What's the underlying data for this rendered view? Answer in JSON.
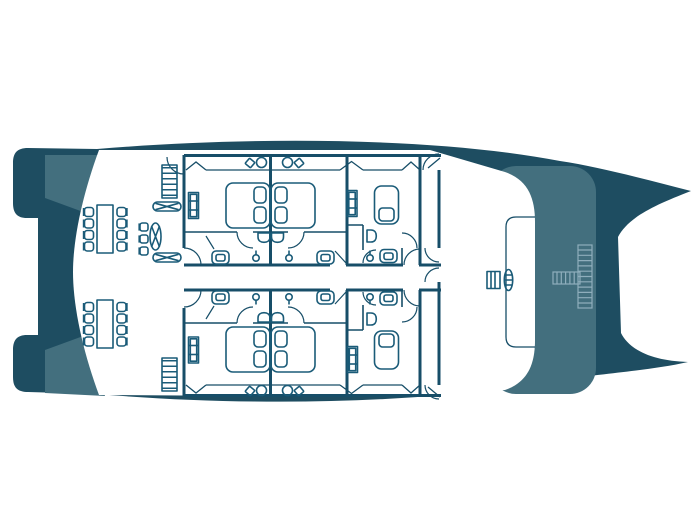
{
  "title": "Catamaran lower deck floor plan",
  "colors": {
    "hull_dark": "#1E4D61",
    "hull_medium": "#436F7E",
    "deck_white": "#FFFFFF",
    "wall_line": "#174E68",
    "furniture_line": "#1A5B78",
    "light_stair_line": "#8FAEBC"
  },
  "plan": {
    "cabins_double": 4,
    "cabins_single": 2,
    "bathrooms": 6,
    "dining_tables": 2,
    "dining_chairs": 16
  },
  "items": [
    {
      "name": "double-bed-cabin-1",
      "sym": "bed-double",
      "x": 248,
      "y": 205.5,
      "sx": 1,
      "sy": 1,
      "r": 0
    },
    {
      "name": "double-bed-cabin-2",
      "sym": "bed-double",
      "x": 293,
      "y": 205.5,
      "sx": -1,
      "sy": 1,
      "r": 0
    },
    {
      "name": "double-bed-cabin-4",
      "sym": "bed-double",
      "x": 248,
      "y": 349.5,
      "sx": 1,
      "sy": 1,
      "r": 0
    },
    {
      "name": "double-bed-cabin-5",
      "sym": "bed-double",
      "x": 293,
      "y": 349.5,
      "sx": -1,
      "sy": 1,
      "r": 0
    },
    {
      "name": "single-bed-cabin-3",
      "sym": "bed-single",
      "x": 386.5,
      "y": 205,
      "sx": 1,
      "sy": 1,
      "r": 0
    },
    {
      "name": "single-bed-cabin-6",
      "sym": "bed-single",
      "x": 386.5,
      "y": 350,
      "sx": 1,
      "sy": -1,
      "r": 0
    },
    {
      "name": "wardrobe-cabin-1",
      "sym": "wardrobe",
      "x": 193.5,
      "y": 205.5,
      "sx": 1,
      "sy": 1,
      "r": 0
    },
    {
      "name": "wardrobe-cabin-4",
      "sym": "wardrobe",
      "x": 193.5,
      "y": 350,
      "sx": 1,
      "sy": 1,
      "r": 0
    },
    {
      "name": "wardrobe-cabin-3",
      "sym": "wardrobe",
      "x": 352,
      "y": 203.5,
      "sx": 1,
      "sy": 1,
      "r": 0
    },
    {
      "name": "wardrobe-cabin-6",
      "sym": "wardrobe",
      "x": 352.5,
      "y": 359.5,
      "sx": 1,
      "sy": 1,
      "r": 0
    },
    {
      "name": "toilet-bath-1",
      "sym": "toilet",
      "x": 220.5,
      "y": 257.5,
      "sx": 1,
      "sy": 1,
      "r": 0
    },
    {
      "name": "toilet-bath-2",
      "sym": "toilet",
      "x": 325.5,
      "y": 257.5,
      "sx": 1,
      "sy": 1,
      "r": 0
    },
    {
      "name": "toilet-bath-3",
      "sym": "toilet",
      "x": 388.5,
      "y": 256,
      "sx": 1,
      "sy": 1,
      "r": 0
    },
    {
      "name": "toilet-bath-4",
      "sym": "toilet",
      "x": 220.5,
      "y": 297.5,
      "sx": 1,
      "sy": -1,
      "r": 0
    },
    {
      "name": "toilet-bath-5",
      "sym": "toilet",
      "x": 325.5,
      "y": 297.5,
      "sx": 1,
      "sy": -1,
      "r": 0
    },
    {
      "name": "toilet-bath-6",
      "sym": "toilet",
      "x": 388.5,
      "y": 298.5,
      "sx": 1,
      "sy": -1,
      "r": 0
    },
    {
      "name": "shower-head-bath-1",
      "sym": "shower-head",
      "x": 256,
      "y": 258,
      "sx": 1,
      "sy": 1,
      "r": 0
    },
    {
      "name": "shower-head-bath-2",
      "sym": "shower-head",
      "x": 289,
      "y": 258,
      "sx": 1,
      "sy": 1,
      "r": 0
    },
    {
      "name": "shower-head-bath-3",
      "sym": "shower-head",
      "x": 370,
      "y": 258,
      "sx": 1,
      "sy": 1,
      "r": 0
    },
    {
      "name": "shower-head-bath-4",
      "sym": "shower-head",
      "x": 256,
      "y": 297,
      "sx": 1,
      "sy": -1,
      "r": 0
    },
    {
      "name": "shower-head-bath-5",
      "sym": "shower-head",
      "x": 289,
      "y": 297,
      "sx": 1,
      "sy": -1,
      "r": 0
    },
    {
      "name": "shower-head-bath-6",
      "sym": "shower-head",
      "x": 370,
      "y": 297,
      "sx": 1,
      "sy": -1,
      "r": 0
    },
    {
      "name": "sink-bath-1",
      "sym": "sink",
      "x": 264,
      "y": 237.5,
      "sx": 1,
      "sy": 1,
      "r": 0
    },
    {
      "name": "sink-bath-2",
      "sym": "sink",
      "x": 277.5,
      "y": 237.5,
      "sx": 1,
      "sy": 1,
      "r": 0
    },
    {
      "name": "sink-bath-4",
      "sym": "sink",
      "x": 264,
      "y": 317.5,
      "sx": 1,
      "sy": -1,
      "r": 0
    },
    {
      "name": "sink-bath-5",
      "sym": "sink",
      "x": 277.5,
      "y": 317.5,
      "sx": 1,
      "sy": -1,
      "r": 0
    },
    {
      "name": "sink-bath-3",
      "sym": "sink",
      "x": 371.5,
      "y": 236,
      "sx": 1,
      "sy": 1,
      "r": -90
    },
    {
      "name": "sink-bath-6",
      "sym": "sink",
      "x": 371.5,
      "y": 319,
      "sx": 1,
      "sy": 1,
      "r": -90
    },
    {
      "name": "vanity-set-cabin-1",
      "sym": "vanity-pair",
      "x": 261.5,
      "y": 162.5,
      "sx": 1,
      "sy": 1,
      "r": 0
    },
    {
      "name": "vanity-set-cabin-2",
      "sym": "vanity-pair",
      "x": 287.5,
      "y": 162.5,
      "sx": -1,
      "sy": 1,
      "r": 0
    },
    {
      "name": "vanity-set-cabin-4",
      "sym": "vanity-pair",
      "x": 261.5,
      "y": 390.5,
      "sx": 1,
      "sy": 1,
      "r": 0
    },
    {
      "name": "vanity-set-cabin-5",
      "sym": "vanity-pair",
      "x": 287.5,
      "y": 390.5,
      "sx": -1,
      "sy": 1,
      "r": 0
    },
    {
      "name": "dining-table-forward",
      "sym": "dining-table",
      "x": 105,
      "y": 229,
      "sx": 1,
      "sy": 1,
      "r": 0
    },
    {
      "name": "dining-table-aft",
      "sym": "dining-table",
      "x": 105,
      "y": 324,
      "sx": 1,
      "sy": 1,
      "r": 0
    },
    {
      "name": "dining-chair",
      "sym": "chair",
      "x": 89,
      "y": 212,
      "sx": 1,
      "sy": 1,
      "r": 0
    },
    {
      "name": "dining-chair",
      "sym": "chair",
      "x": 89,
      "y": 223.5,
      "sx": 1,
      "sy": 1,
      "r": 0
    },
    {
      "name": "dining-chair",
      "sym": "chair",
      "x": 89,
      "y": 235,
      "sx": 1,
      "sy": 1,
      "r": 0
    },
    {
      "name": "dining-chair",
      "sym": "chair",
      "x": 89,
      "y": 246.5,
      "sx": 1,
      "sy": 1,
      "r": 0
    },
    {
      "name": "dining-chair",
      "sym": "chair",
      "x": 121.5,
      "y": 212,
      "sx": -1,
      "sy": 1,
      "r": 0
    },
    {
      "name": "dining-chair",
      "sym": "chair",
      "x": 121.5,
      "y": 223.5,
      "sx": -1,
      "sy": 1,
      "r": 0
    },
    {
      "name": "dining-chair",
      "sym": "chair",
      "x": 121.5,
      "y": 235,
      "sx": -1,
      "sy": 1,
      "r": 0
    },
    {
      "name": "dining-chair",
      "sym": "chair",
      "x": 121.5,
      "y": 246.5,
      "sx": -1,
      "sy": 1,
      "r": 0
    },
    {
      "name": "dining-chair",
      "sym": "chair",
      "x": 89,
      "y": 307,
      "sx": 1,
      "sy": 1,
      "r": 0
    },
    {
      "name": "dining-chair",
      "sym": "chair",
      "x": 89,
      "y": 318.5,
      "sx": 1,
      "sy": 1,
      "r": 0
    },
    {
      "name": "dining-chair",
      "sym": "chair",
      "x": 89,
      "y": 330,
      "sx": 1,
      "sy": 1,
      "r": 0
    },
    {
      "name": "dining-chair",
      "sym": "chair",
      "x": 89,
      "y": 341.5,
      "sx": 1,
      "sy": 1,
      "r": 0
    },
    {
      "name": "dining-chair",
      "sym": "chair",
      "x": 121.5,
      "y": 307,
      "sx": -1,
      "sy": 1,
      "r": 0
    },
    {
      "name": "dining-chair",
      "sym": "chair",
      "x": 121.5,
      "y": 318.5,
      "sx": -1,
      "sy": 1,
      "r": 0
    },
    {
      "name": "dining-chair",
      "sym": "chair",
      "x": 121.5,
      "y": 330,
      "sx": -1,
      "sy": 1,
      "r": 0
    },
    {
      "name": "dining-chair",
      "sym": "chair",
      "x": 121.5,
      "y": 341.5,
      "sx": -1,
      "sy": 1,
      "r": 0
    },
    {
      "name": "companionway-stairs-forward",
      "sym": "stairs",
      "x": 169.5,
      "y": 181.5,
      "sx": 1,
      "sy": 1,
      "r": 0
    },
    {
      "name": "companionway-stairs-aft",
      "sym": "stairs",
      "x": 169.5,
      "y": 374.5,
      "sx": 1,
      "sy": 1,
      "r": 0
    },
    {
      "name": "lounge-bench-1",
      "sym": "xbench",
      "x": 167,
      "y": 206.5,
      "sx": 1,
      "sy": 1,
      "r": 0
    },
    {
      "name": "lounge-bench-2",
      "sym": "xbench",
      "x": 167,
      "y": 257.5,
      "sx": 1,
      "sy": 1,
      "r": 0
    },
    {
      "name": "lounge-cot",
      "sym": "lounge-oval",
      "x": 155.5,
      "y": 236.5,
      "sx": 1,
      "sy": 1,
      "r": 0
    },
    {
      "name": "lounge-stool",
      "sym": "small-chair",
      "x": 144,
      "y": 227,
      "sx": 1,
      "sy": 1,
      "r": 0
    },
    {
      "name": "lounge-stool",
      "sym": "small-chair",
      "x": 144,
      "y": 239,
      "sx": 1,
      "sy": 1,
      "r": 0
    },
    {
      "name": "lounge-stool",
      "sym": "small-chair",
      "x": 144,
      "y": 251,
      "sx": 1,
      "sy": 1,
      "r": 0
    },
    {
      "name": "helm-station",
      "sym": "helm",
      "x": 501,
      "y": 280,
      "sx": 1,
      "sy": 1,
      "r": 0
    },
    {
      "name": "deck-stairs-cross",
      "sym": "stairs-cross",
      "x": 578,
      "y": 245,
      "sx": 1,
      "sy": 1,
      "r": 0
    }
  ]
}
